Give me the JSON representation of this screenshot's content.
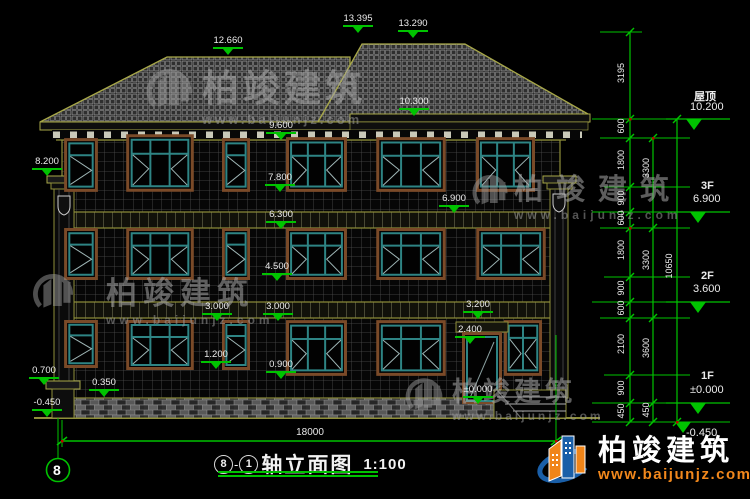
{
  "title_bar": {
    "axis_start": "8",
    "axis_sep": "-",
    "axis_end": "1",
    "name": "轴立面图",
    "scale": "1:100"
  },
  "axis": {
    "bottom_left_bubble": "8"
  },
  "dimensions": {
    "overall_width": "18000",
    "right_chain_inner": [
      "3195",
      "600",
      "1800",
      "900",
      "600",
      "1800",
      "900",
      "600",
      "2100",
      "900",
      "450"
    ],
    "right_chain_mid": [
      "3300",
      "3300",
      "3600",
      "450"
    ],
    "right_chain_outer": [
      "10650"
    ]
  },
  "elevation_marks": [
    {
      "value": "12.660"
    },
    {
      "value": "13.395"
    },
    {
      "value": "13.290"
    },
    {
      "value": "10.300"
    },
    {
      "value": "9.600"
    },
    {
      "value": "8.200"
    },
    {
      "value": "7.800"
    },
    {
      "value": "6.900"
    },
    {
      "value": "6.300"
    },
    {
      "value": "4.500"
    },
    {
      "value": "3.000"
    },
    {
      "value": "3.000"
    },
    {
      "value": "3.200"
    },
    {
      "value": "2.400"
    },
    {
      "value": "1.200"
    },
    {
      "value": "0.900"
    },
    {
      "value": "0.700"
    },
    {
      "value": "0.350"
    },
    {
      "value": "-0.450"
    },
    {
      "value": "±0.000"
    }
  ],
  "floor_levels": [
    {
      "label": "屋顶",
      "value": "10.200"
    },
    {
      "label": "3F",
      "value": "6.900"
    },
    {
      "label": "2F",
      "value": "3.600"
    },
    {
      "label": "1F",
      "value": "±0.000"
    },
    {
      "label": "",
      "value": "-0.450"
    }
  ],
  "watermark": {
    "brand": "柏竣建筑",
    "url": "www.baijunjz.com"
  },
  "footer_logo": {
    "brand": "柏竣建筑",
    "url": "www.baijunjz.com"
  },
  "colors": {
    "dim_green": "#00c300",
    "line_olive": "#8f8f3a",
    "roof_edge": "#a8a848",
    "frame_teal": "#2e8484",
    "surround_brown": "#7a4a28",
    "logo_blue": "#1a5fa8",
    "logo_orange": "#f08519"
  }
}
